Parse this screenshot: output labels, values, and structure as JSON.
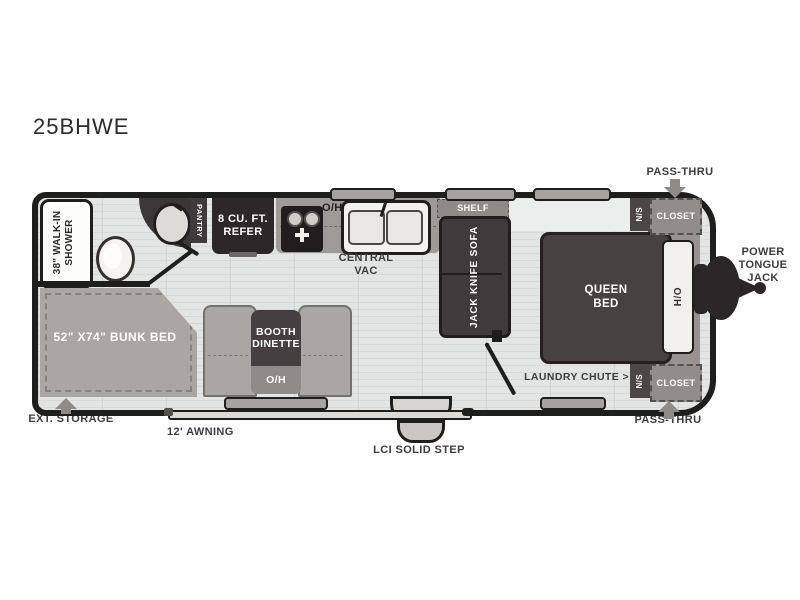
{
  "model": "25BHWE",
  "exterior": {
    "pass_thru_top": "PASS-THRU",
    "pass_thru_bottom": "PASS-THRU",
    "power_tongue_jack": "POWER TONGUE JACK",
    "ext_storage": "EXT. STORAGE",
    "awning": "12' AWNING",
    "step": "LCI SOLID STEP"
  },
  "bathroom": {
    "shower": "38\" WALK-IN SHOWER",
    "pantry": "PANTRY"
  },
  "kitchen": {
    "refer": "8 CU. FT. REFER",
    "overhead": "O/H",
    "central_vac": "CENTRAL VAC"
  },
  "living": {
    "shelf": "SHELF",
    "sofa": "JACK KNIFE SOFA",
    "bunk_bed": "52\" X74\" BUNK BED",
    "dinette": "BOOTH DINETTE",
    "dinette_overhead": "O/H"
  },
  "bedroom": {
    "bed": "QUEEN BED",
    "headboard_overhead": "H/O",
    "nightstand_top": "N/S",
    "nightstand_bottom": "N/S",
    "closet_top": "CLOSET",
    "closet_bottom": "CLOSET",
    "laundry_chute": "LAUNDRY CHUTE >"
  },
  "colors": {
    "wall": "#1e1e1c",
    "dark_furniture": "#3f3a3b",
    "medium_gray": "#8e8b89",
    "taupe": "#aaa6a3",
    "floor": "#e3e5e4"
  }
}
